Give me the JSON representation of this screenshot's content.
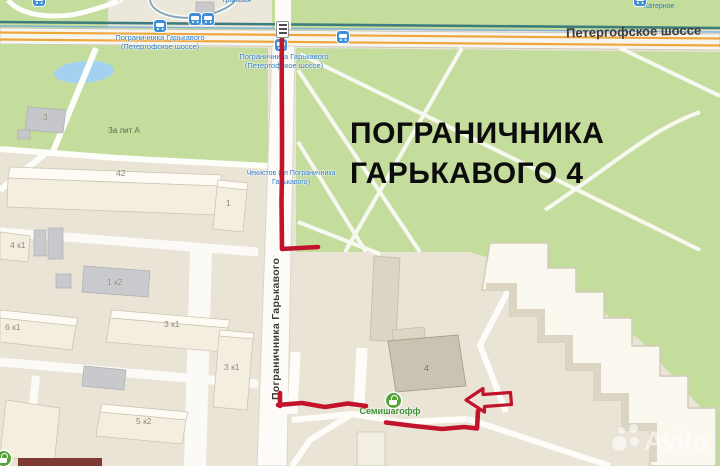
{
  "title": {
    "line1": "ПОГРАНИЧНИКА",
    "line2": "ГАРЬКАВОГО 4"
  },
  "streets": {
    "highway": "Петергофское шоссе",
    "main": "Пограничника Гарькавого"
  },
  "bus_stops": [
    {
      "line1": "Пограничника Гарькавого",
      "line2": "(Петергофское шоссе)"
    },
    {
      "line1": "Пограничника Гарькавого",
      "line2": "(Петергофское шоссе)"
    },
    {
      "line1": "Чекистов (ул Пограничника",
      "line2": "Гарькавого)"
    }
  ],
  "area_labels": {
    "za_lit_a": "За лит А",
    "katernoe": "Катерное",
    "tram_fragment": "трамвая"
  },
  "buildings": [
    {
      "label": "3"
    },
    {
      "label": "42"
    },
    {
      "label": "1"
    },
    {
      "label": "4 к1"
    },
    {
      "label": "1 к2"
    },
    {
      "label": "6 к1"
    },
    {
      "label": "3 к1"
    },
    {
      "label": "3 к1"
    },
    {
      "label": "5 к2"
    },
    {
      "label": "4"
    }
  ],
  "store": {
    "name": "Семишагофф"
  },
  "watermark": {
    "text": "Avito"
  },
  "colors": {
    "route": "#c1142c",
    "park": "#c4dc9c",
    "bus_icon": "#3e8ed8",
    "store_icon": "#57a33b",
    "highway_line": "#efa73c",
    "bus_label": "#2d7cc4"
  }
}
